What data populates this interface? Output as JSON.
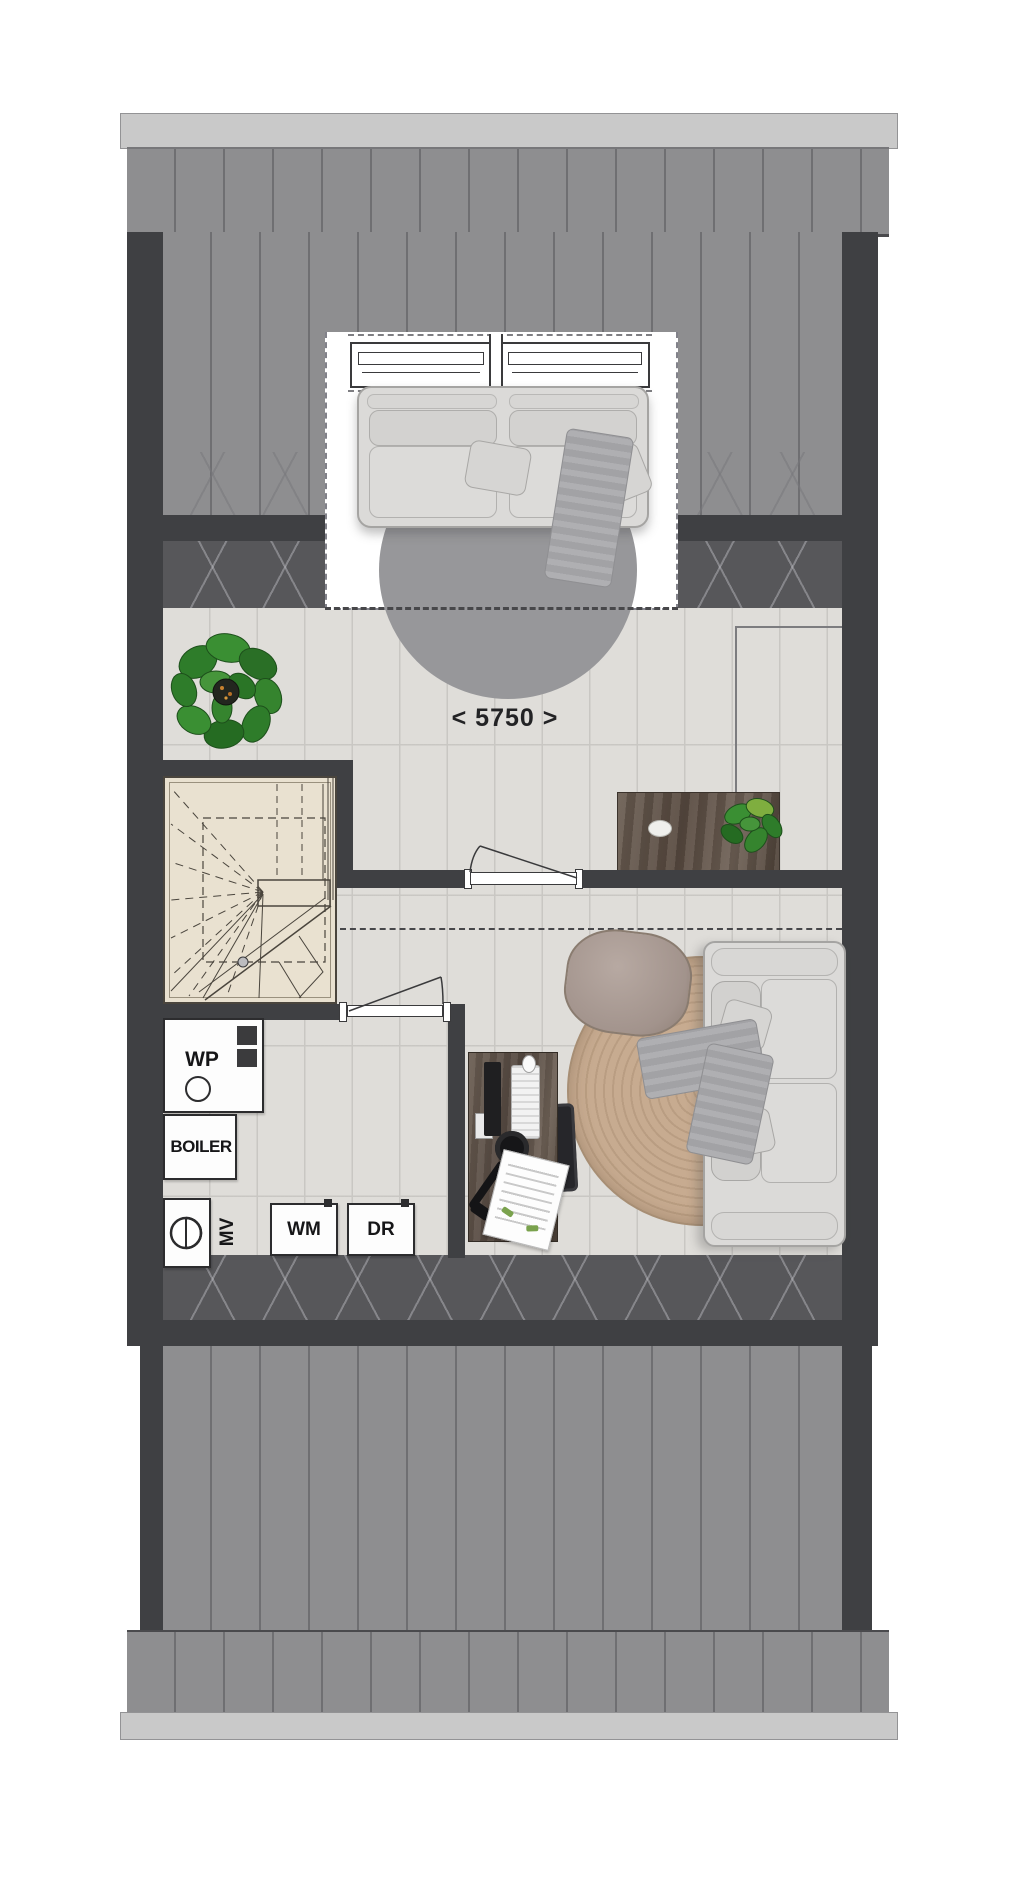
{
  "plan": {
    "type": "attic-floor-plan",
    "dimension_label": "< 5750 >",
    "equipment": {
      "heat_pump": "WP",
      "boiler": "BOILER",
      "mechanical_ventilation": "MV",
      "washing_machine": "WM",
      "dryer": "DR"
    }
  },
  "colors": {
    "wall_dark": "#3f4043",
    "roof_plank": "#8e8e90",
    "roof_plank_joint": "#6f6f72",
    "gutter_light": "#c9c9c9",
    "sloped_ceiling_band": "#57575a",
    "chevron_line": "#bebec4",
    "floor_wood": "#dfddd9",
    "stair_tread": "#e9e1d0",
    "rug_gray": "#97979a",
    "rug_jute": "#c2a68c",
    "furniture_wood": "#5e5349",
    "sofa_fabric": "#dbdad8",
    "pouf": "#a2938c",
    "plant_green": "#2f7d2b",
    "dashed_line": "#47474a"
  }
}
